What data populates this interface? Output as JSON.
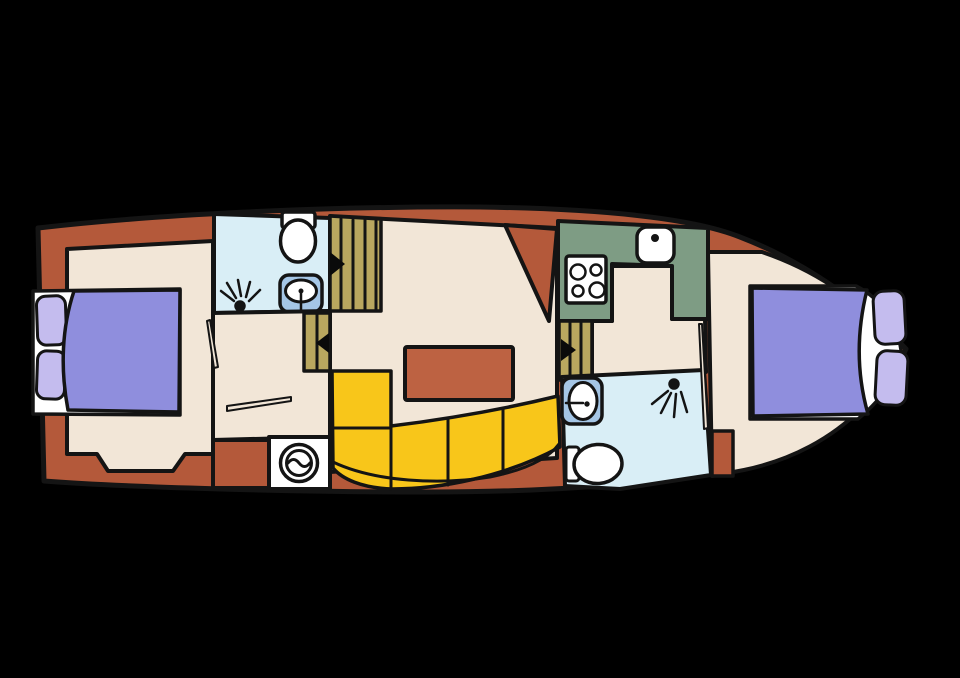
{
  "diagram": {
    "type": "boat-deck-floorplan",
    "orientation": "bow-right",
    "rooms": [
      {
        "id": "aft-cabin",
        "kind": "double-bed-cabin"
      },
      {
        "id": "aft-bathroom",
        "kind": "bathroom-with-shower-toilet-sink"
      },
      {
        "id": "laundry-nook",
        "kind": "washing-machine"
      },
      {
        "id": "salon",
        "kind": "seating-area-with-table"
      },
      {
        "id": "galley",
        "kind": "kitchen-with-stove-and-sink"
      },
      {
        "id": "fore-bathroom",
        "kind": "bathroom-with-shower-toilet-sink"
      },
      {
        "id": "fore-cabin",
        "kind": "double-bed-cabin"
      }
    ],
    "stairs": [
      {
        "id": "stairs-aft-top",
        "direction": "right"
      },
      {
        "id": "stairs-mid",
        "direction": "left"
      },
      {
        "id": "stairs-fore",
        "direction": "right"
      }
    ],
    "furniture": [
      "double-bed",
      "pillows",
      "l-shaped-sofa",
      "dinette-table",
      "stove-4-burner",
      "kitchen-sink",
      "washing-machine",
      "toilet",
      "washbasin",
      "shower-head"
    ]
  },
  "colors": {
    "background": "#000000",
    "wall": "#141414",
    "arrow": "#0a0a0a",
    "hull": "#b4593a",
    "floor": "#f2e6d7",
    "bathroom": "#d9eef6",
    "sink": "#a5c6e6",
    "bed": "#8f8edd",
    "pillow": "#c4bcee",
    "sofa": "#f8c61a",
    "stairs": "#b9a75f",
    "kitchen": "#7e9c84",
    "fixture": "#ffffff",
    "table": "#bd6242"
  }
}
